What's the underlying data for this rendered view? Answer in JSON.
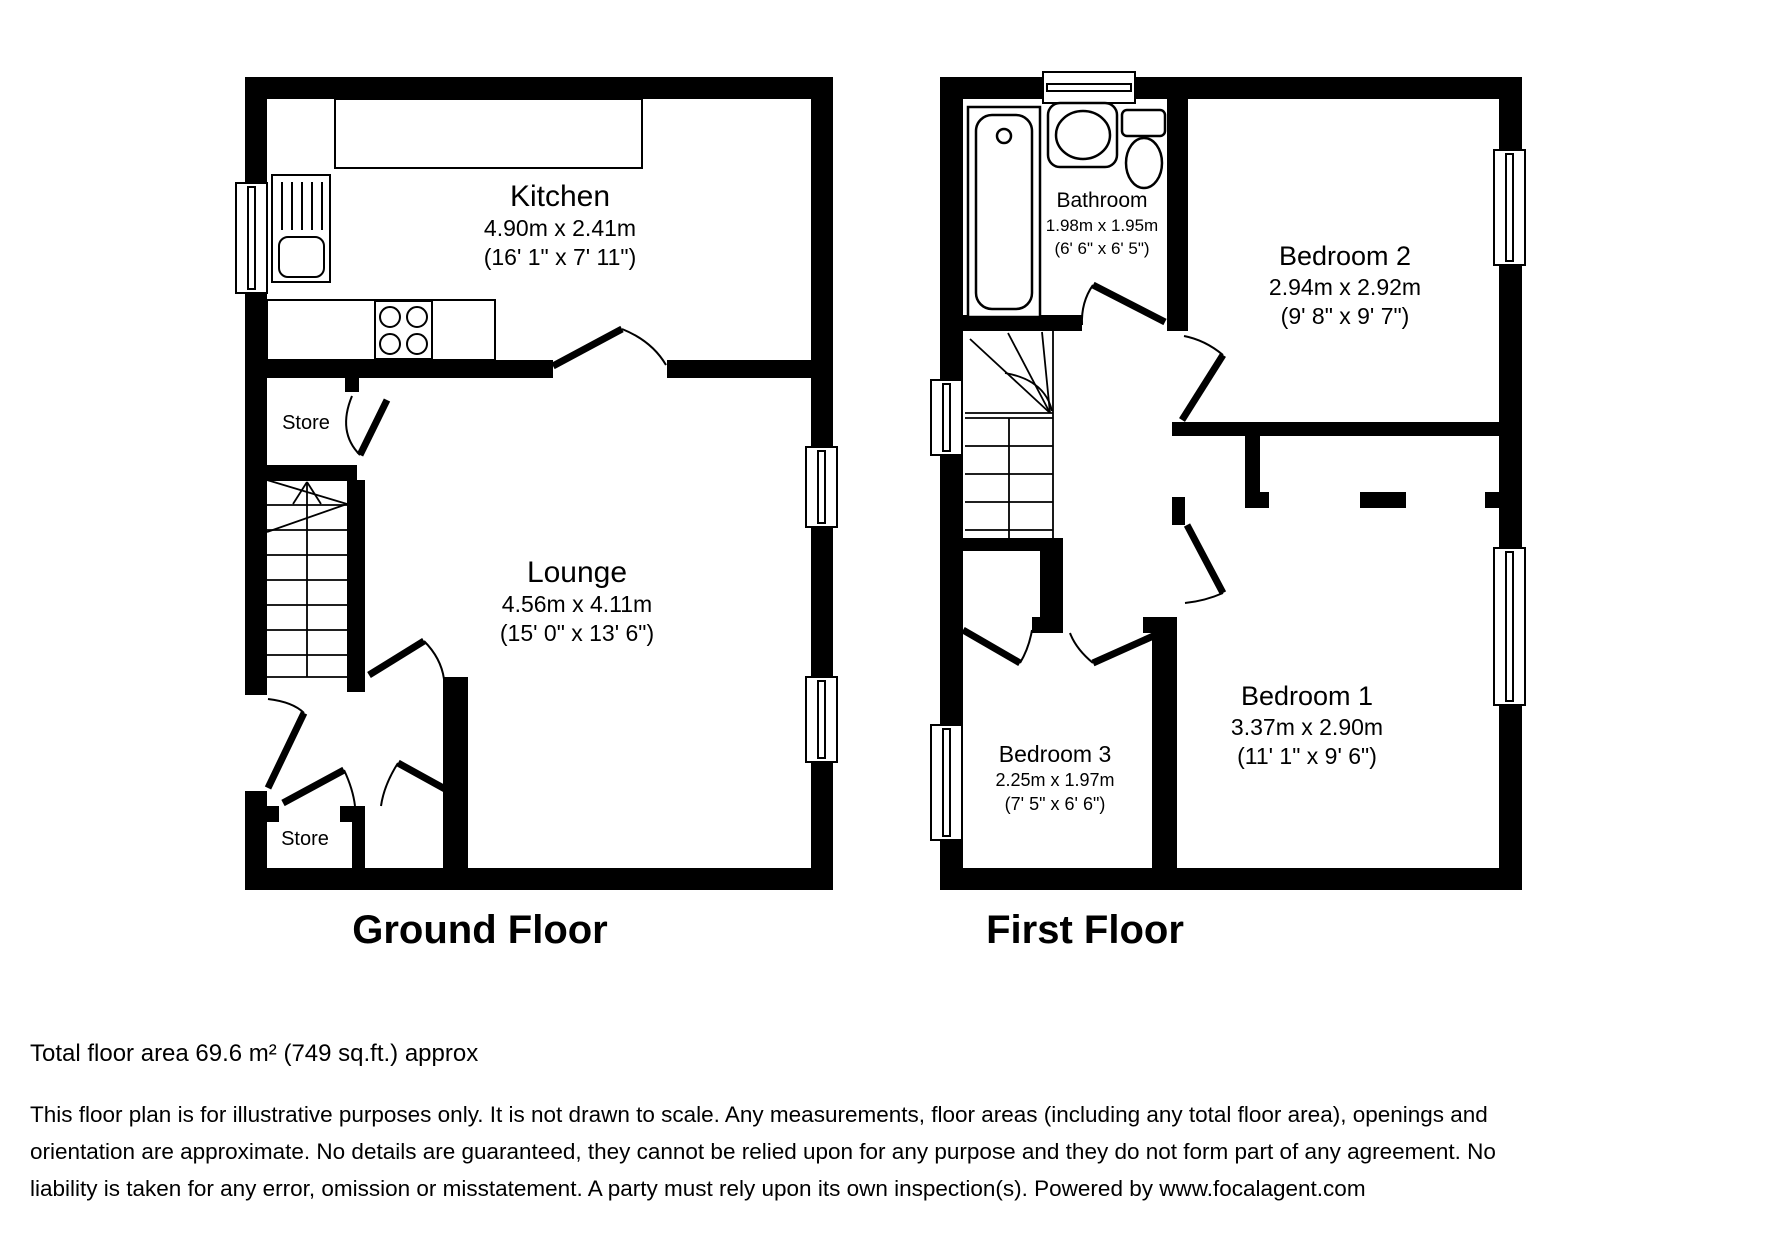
{
  "page": {
    "background": "#ffffff",
    "wall_color": "#000000",
    "line_color": "#000000"
  },
  "ground_floor": {
    "title": "Ground Floor",
    "rooms": {
      "kitchen": {
        "name": "Kitchen",
        "metric": "4.90m x 2.41m",
        "imperial": "(16' 1\" x 7' 11\")"
      },
      "lounge": {
        "name": "Lounge",
        "metric": "4.56m x 4.11m",
        "imperial": "(15' 0\" x 13' 6\")"
      },
      "store_top": {
        "name": "Store"
      },
      "store_bottom": {
        "name": "Store"
      }
    },
    "fixtures": [
      "sink-drainer",
      "hob",
      "stairs-up"
    ]
  },
  "first_floor": {
    "title": "First Floor",
    "rooms": {
      "bathroom": {
        "name": "Bathroom",
        "metric": "1.98m x 1.95m",
        "imperial": "(6' 6\" x 6' 5\")"
      },
      "bedroom2": {
        "name": "Bedroom 2",
        "metric": "2.94m x 2.92m",
        "imperial": "(9' 8\" x 9' 7\")"
      },
      "bedroom1": {
        "name": "Bedroom 1",
        "metric": "3.37m x 2.90m",
        "imperial": "(11' 1\" x 9' 6\")"
      },
      "bedroom3": {
        "name": "Bedroom 3",
        "metric": "2.25m x 1.97m",
        "imperial": "(7' 5\" x 6' 6\")"
      }
    },
    "fixtures": [
      "bath",
      "basin",
      "toilet",
      "stairs-down"
    ]
  },
  "footer": {
    "total_area": "Total floor area 69.6 m² (749 sq.ft.) approx",
    "disclaimer": "This floor plan is for illustrative purposes only. It is not drawn to scale. Any measurements, floor areas (including any total floor area), openings and orientation are approximate. No details are guaranteed, they cannot be relied upon for any purpose and they do not form part of any agreement. No liability is taken for any error, omission or misstatement. A party must rely upon its own inspection(s). Powered by www.focalagent.com"
  }
}
